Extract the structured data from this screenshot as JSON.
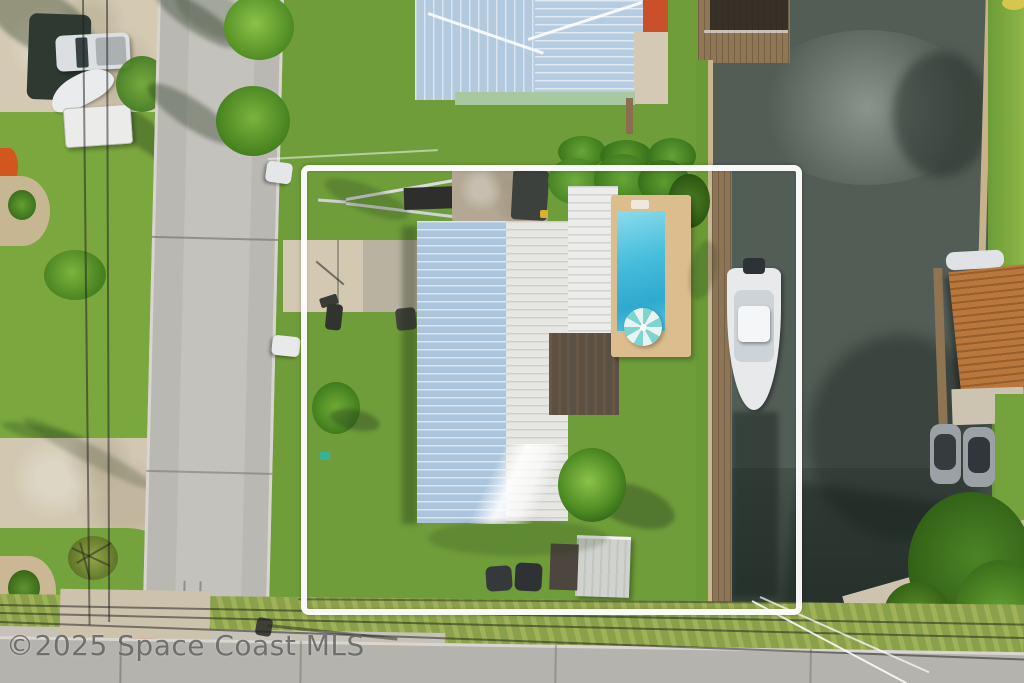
{
  "image": {
    "type": "aerial-drone-real-estate-photo",
    "description": "Overhead aerial view of a waterfront residential lot outlined with a white property boundary; house with light-blue and white metal roof, swimming pool with teal umbrella, boat docked on canal, street at left, canal at right"
  },
  "watermark": {
    "text": "©2025 Space Coast MLS",
    "color": "#5c5c5c"
  },
  "scene": {
    "property_boundary": {
      "label": "white property boundary outline",
      "color": "#ffffff"
    },
    "main_house": {
      "roof_left": "light-blue corrugated metal",
      "roof_right": "white metal",
      "rear_roof": "dark brown flat roof",
      "color_blue": "#abc5dd",
      "color_white": "#e9eae6",
      "color_dark": "#5b5044"
    },
    "swimming_pool": {
      "label": "rectangular pool",
      "water_color": "#3fb6d8",
      "deck_color": "#dcbd8e",
      "umbrella_color": "#7fd4cf"
    },
    "boat": {
      "label": "white center-console boat at dock",
      "color": "#e7e9eb"
    },
    "canal": {
      "label": "canal waterway",
      "color": "#525d56"
    },
    "docks": {
      "label": "wooden docks and seawall",
      "color": "#8d7555"
    },
    "roads": {
      "left_street": "#bab8b2",
      "bottom_street": "#b5b3ad"
    },
    "neighbor_top": {
      "label": "neighbor house with light-blue metal roof and orange section",
      "orange": "#c9502b"
    },
    "neighbor_right": {
      "label": "neighbor house with orange shingle roof and two jet-skis",
      "roof": "#b9773c"
    },
    "yard_items": [
      "boat trailer",
      "storage shed",
      "trash bins",
      "palm trees",
      "basketball hoop"
    ],
    "street_items": [
      "parked pickup truck",
      "boat on trailer",
      "white utility trailer",
      "parked white cars",
      "power lines",
      "red curb marking"
    ]
  }
}
